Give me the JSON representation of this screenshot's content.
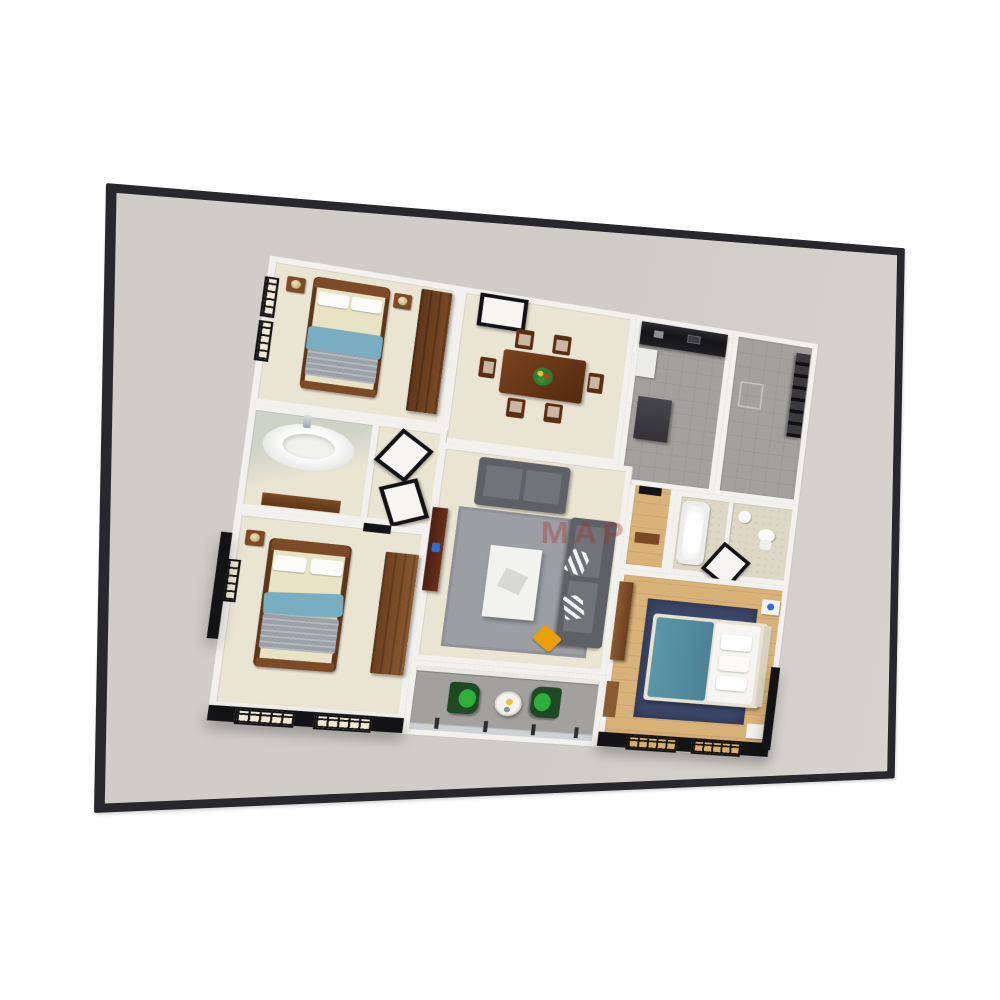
{
  "scene": {
    "kind": "3d-rendered apartment floor plan shown on a dark framed wall panel",
    "watermark": {
      "text": "MAP"
    },
    "display": {
      "frame": "thin dark charcoal bezel, panel angled with right edge receding",
      "screen_background": "light warm gray"
    },
    "rooms": [
      {
        "name": "bedroom-1",
        "position": "top-left",
        "floor": "cream",
        "furniture": [
          "double-bed with blue blanket and gray throw",
          "2 white pillows",
          "2 nightstands with lamps",
          "tall dark-brown wardrobe",
          "black framed windows on left wall"
        ]
      },
      {
        "name": "dining-room",
        "position": "top-center",
        "floor": "cream",
        "furniture": [
          "rectangular wooden dining table",
          "6 wooden chairs with beige seats",
          "fruit bowl centerpiece",
          "entry door panel on top wall"
        ]
      },
      {
        "name": "kitchen",
        "position": "top-right",
        "floor": "gray-tile",
        "furniture": [
          "glossy black counter along top wall",
          "dark island",
          "white fridge"
        ]
      },
      {
        "name": "utility-room",
        "position": "top-right corner",
        "floor": "gray-tile",
        "furniture": [
          "black shelving rack"
        ]
      },
      {
        "name": "bathroom-1",
        "position": "middle-left",
        "floor": "cream",
        "furniture": [
          "large white oval bathtub",
          "chrome faucet",
          "brown vanity"
        ]
      },
      {
        "name": "hallway",
        "position": "center-left",
        "floor": "cream",
        "furniture": [
          "two white door panels with black frames"
        ]
      },
      {
        "name": "bedroom-2",
        "position": "bottom-left",
        "floor": "cream",
        "furniture": [
          "double-bed with blue blanket and textured gray throw",
          "nightstand with lamp",
          "brown wardrobe",
          "black exterior wall with lattice windows"
        ]
      },
      {
        "name": "living-room",
        "position": "center",
        "floor": "cream",
        "furniture": [
          "gray loveseat",
          "long gray sofa with striped cushions",
          "gray rug",
          "white coffee table",
          "yellow throw pillow",
          "dark redwood tv-console"
        ]
      },
      {
        "name": "balcony",
        "position": "bottom-center",
        "floor": "concrete-gray",
        "furniture": [
          "2 green armchairs",
          "small round white table",
          "glass railing with posts",
          "sliding glass door"
        ]
      },
      {
        "name": "bathroom-2",
        "position": "middle-right",
        "floor": "beige-pattern",
        "furniture": [
          "bathtub",
          "toilet",
          "sink",
          "door panel"
        ]
      },
      {
        "name": "master-bedroom",
        "position": "bottom-right",
        "floor": "oak-wood",
        "furniture": [
          "double-bed with teal blanket and white duvet",
          "navy rug",
          "2 white nightstands",
          "brown wall cabinets",
          "black exterior wall with amber lattice windows"
        ]
      }
    ],
    "colors": {
      "frame": "#28282c",
      "screen": "#d0cdc8",
      "screenLight": "#d6d3ce",
      "wall": "#f2f1ee",
      "wallShade": "#c9c7c2",
      "floorCream": "#eae4d3",
      "floorGray": "#a3a19e",
      "floorOak": "#d9b279",
      "floorBeige": "#ddd7c5",
      "blackWall": "#131316",
      "paneWhite": "#f1e9d6",
      "paneAmber": "#d9ae67",
      "woodDark": "#5e3619",
      "woodMid": "#7c4a26",
      "mattress": "#e9e3c6",
      "pillow": "#fbfbf9",
      "blanketBlue": "#79aec2",
      "blanketGray": "#9aa0a8",
      "sofa": "#707378",
      "sofaDark": "#5d6065",
      "rug": "#9b9ea3",
      "rugNavy": "#3c4769",
      "tealBed": "#5c96a9",
      "yellow": "#e8a00d",
      "greenBack": "#1d4a22",
      "greenSeat": "#2fae3c",
      "counterBlack": "#151517",
      "tableWhite": "#f2f2f0",
      "watermark": "#a82d28"
    }
  }
}
